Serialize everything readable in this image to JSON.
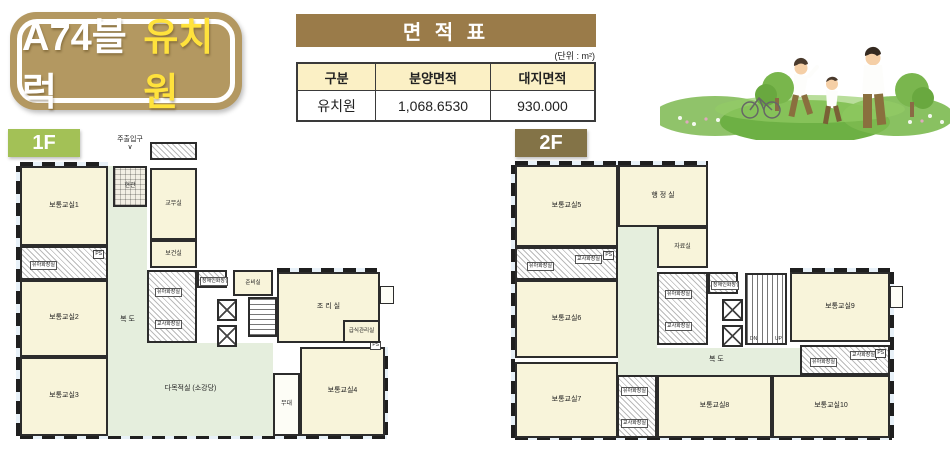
{
  "title_badge": {
    "block": "A74블럭",
    "kind": "유치원"
  },
  "area_table": {
    "title": "면 적 표",
    "unit_note": "(단위 : m²)",
    "headers": [
      "구분",
      "분양면적",
      "대지면적"
    ],
    "row": {
      "category": "유치원",
      "sale_area": "1,068.6530",
      "site_area": "930.000"
    }
  },
  "floors": {
    "f1": {
      "label": "1F",
      "main_entrance": "주출입구",
      "entrance_arrow": "∨",
      "rooms": {
        "classroom1": "보통교실1",
        "classroom2": "보통교실2",
        "classroom3": "보통교실3",
        "classroom4": "보통교실4",
        "entrance": "현관",
        "teachers_office": "교무실",
        "health_room": "보건실",
        "corridor": "복 도",
        "prep_room": "준비실",
        "kitchen": "조 리 실",
        "meal_admin": "급식관리실",
        "multipurpose": "다목적실 (소강당)",
        "stage": "무대",
        "kids_toilet": "유아화장실",
        "teachers_toilet": "교사화장실",
        "disabled_toilet": "장애인화장실",
        "ps": "PS"
      }
    },
    "f2": {
      "label": "2F",
      "rooms": {
        "classroom5": "보통교실5",
        "classroom6": "보통교실6",
        "classroom7": "보통교실7",
        "classroom8": "보통교실8",
        "classroom9": "보통교실9",
        "classroom10": "보통교실10",
        "admin_office": "행 정 실",
        "archive": "자료실",
        "corridor": "복 도",
        "kids_toilet": "유아화장실",
        "teachers_toilet": "교사화장실",
        "disabled_toilet": "장애인화장실",
        "dn": "DN",
        "up": "UP",
        "ps": "PS"
      }
    }
  },
  "colors": {
    "badge_brown": "#b39861",
    "table_brown": "#9a7b49",
    "floor1_green": "#a3c156",
    "floor2_brown": "#837347",
    "room_cream": "#f8f4da",
    "corridor_green": "#e5eedd"
  },
  "illustration": {
    "name": "family-playing-in-grass"
  }
}
